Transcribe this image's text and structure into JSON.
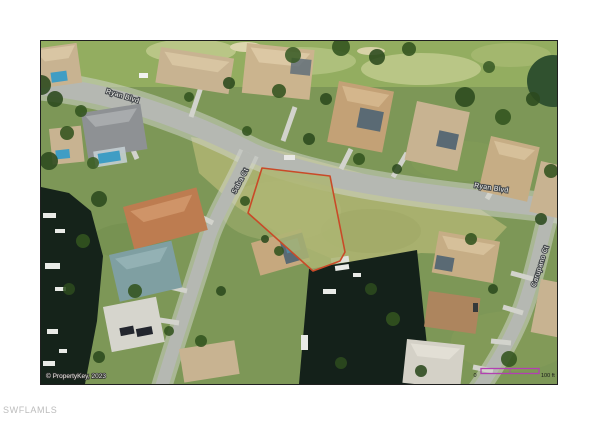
{
  "page": {
    "watermark": "SWFLAMLS",
    "background_color": "#ffffff"
  },
  "photo": {
    "kind": "aerial-satellite-photo",
    "border_color": "#1f1f1f",
    "copyright": "© PropertyKey, 2023",
    "street_labels": {
      "ryan_blvd_upper": "Ryan Blvd",
      "ryan_blvd_lower": "Ryan Blvd",
      "saba_ct": "Saba Ct",
      "carupano_ct": "Carupano Ct"
    },
    "lot_outline": {
      "color": "#c94a28"
    },
    "scale_bar": {
      "color": "#b23fb2",
      "zero_label": "0",
      "distance_label": "100 ft"
    },
    "colors": {
      "grass": "#7d9757",
      "vacant_lot_grass": "#adb573",
      "road": "#b5b8b2",
      "canal_water": "#15231a",
      "roof_tan": "#c8b391",
      "pool_blue": "#3f9dc4"
    }
  }
}
